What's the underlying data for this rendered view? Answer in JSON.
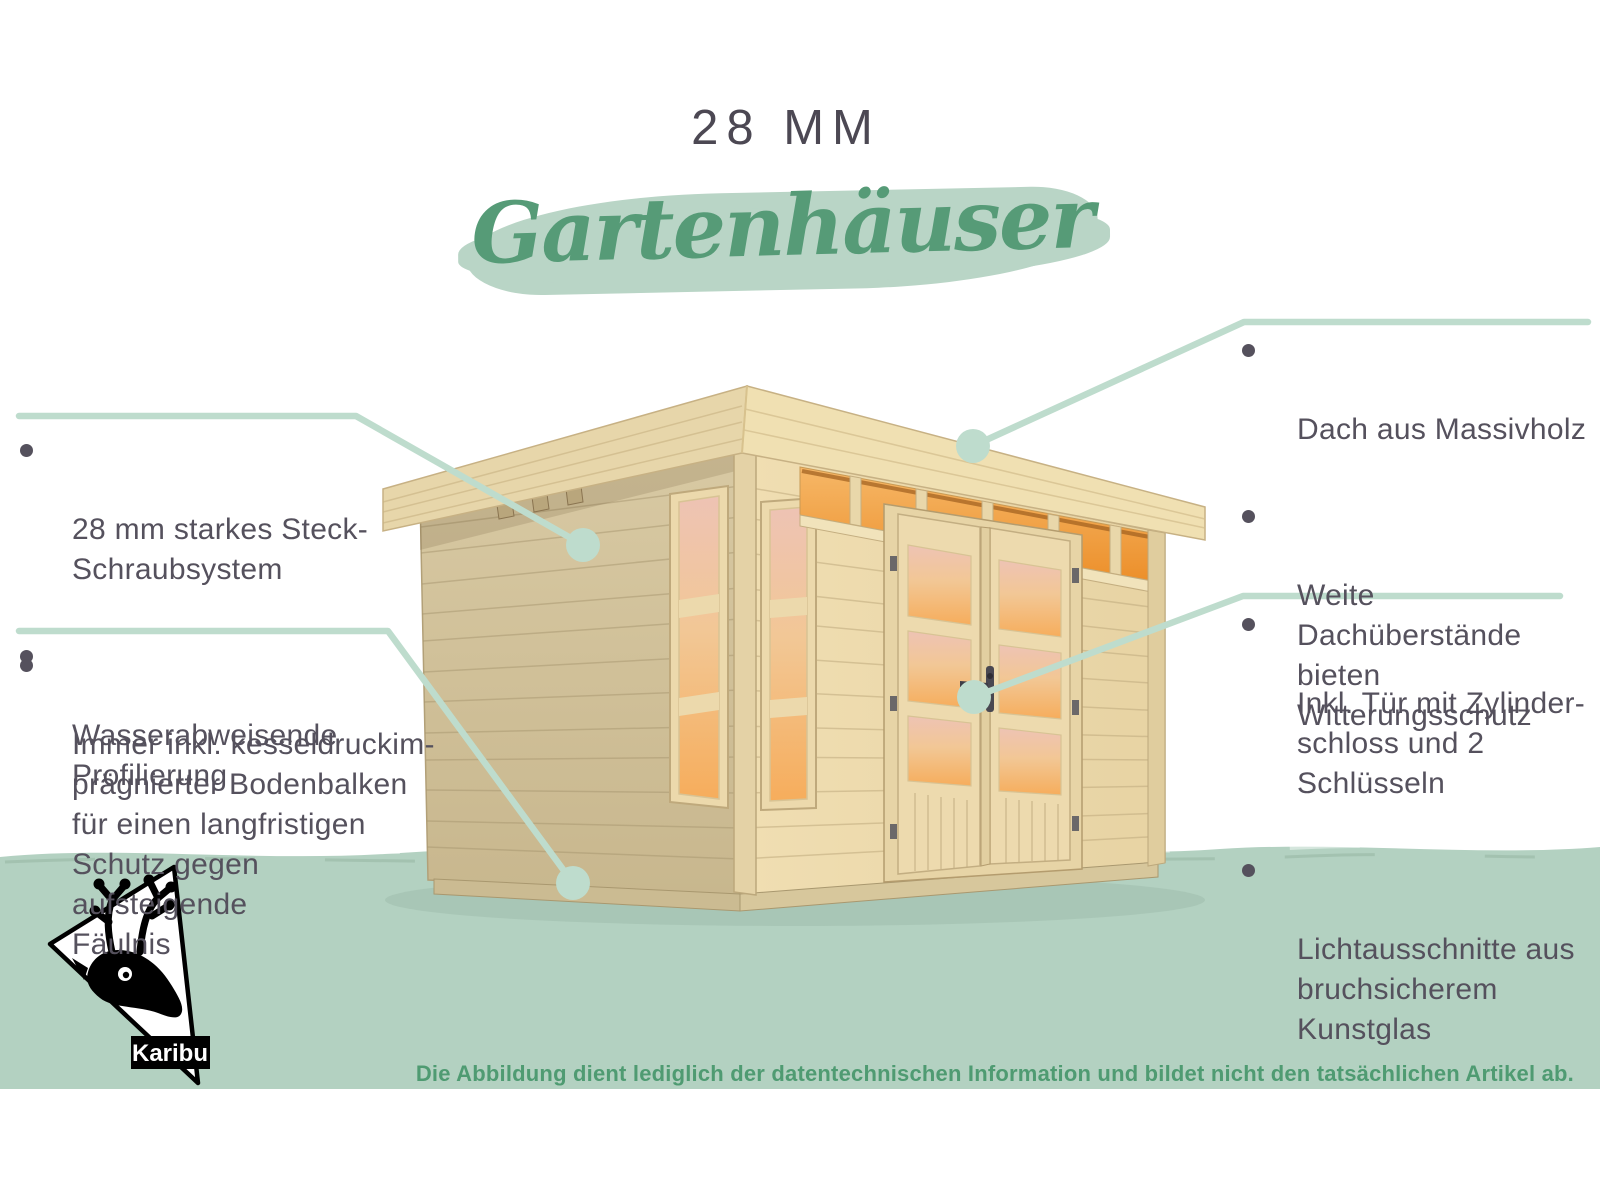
{
  "header": {
    "thickness_label": "28 MM",
    "category_label": "Gartenhäuser"
  },
  "callouts": {
    "wall_system": {
      "items": [
        "28 mm starkes Steck-\nSchraubsystem",
        "Wasserabweisende\nProfilierung"
      ]
    },
    "floor_beams": {
      "items": [
        "Immer inkl. kesseldruckim-\nprägnierter Bodenbalken\nfür einen langfristigen\nSchutz gegen aufsteigende\nFäulnis"
      ]
    },
    "roof": {
      "items": [
        "Dach aus Massivholz",
        "Weite Dachüberstände\nbieten Witterungsschutz"
      ]
    },
    "door": {
      "items": [
        "Inkl. Tür mit Zylinder-\nschloss und 2 Schlüsseln",
        "Lichtausschnitte aus\nbruchsicherem Kunstglas"
      ]
    }
  },
  "footer": {
    "disclaimer": "Die Abbildung dient lediglich der datentechnischen Information und bildet nicht den tatsächlichen Artikel ab."
  },
  "logo": {
    "brand": "Karibu"
  },
  "colors": {
    "callout_line_green": "#bedccd",
    "brush_green": "#b9d5c6",
    "script_green": "#569b77",
    "band_green": "#b3d1c1",
    "disclaimer_green": "#4f9b72",
    "heading_gray": "#4c4853",
    "text_gray": "#55515d",
    "wood_light": "#eedcb0",
    "wood_shaded": "#d0c098",
    "window_glow_orange": "#f5ad5e"
  }
}
